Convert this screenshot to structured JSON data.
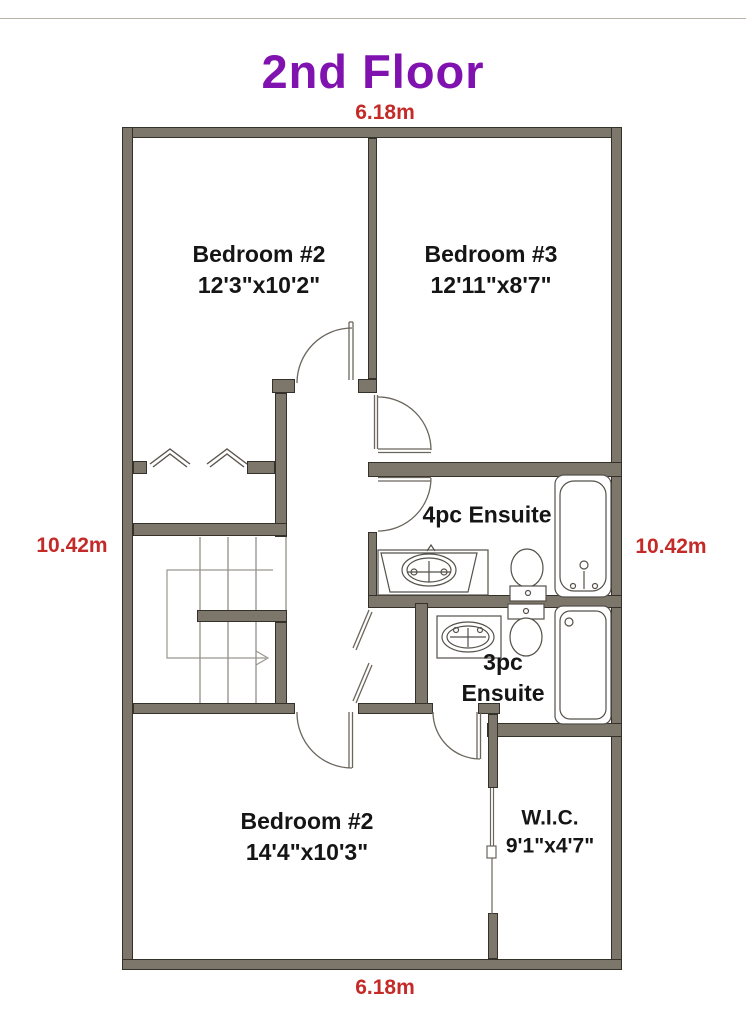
{
  "title": "2nd Floor",
  "dimensions": {
    "top": "6.18m",
    "bottom": "6.18m",
    "left": "10.42m",
    "right": "10.42m"
  },
  "rooms": {
    "bedroom2_top": {
      "name": "Bedroom #2",
      "size": "12'3\"x10'2\""
    },
    "bedroom3": {
      "name": "Bedroom #3",
      "size": "12'11\"x8'7\""
    },
    "ensuite_4pc": {
      "name": "4pc Ensuite"
    },
    "ensuite_3pc": {
      "line1": "3pc",
      "line2": "Ensuite"
    },
    "bedroom2_bottom": {
      "name": "Bedroom #2",
      "size": "14'4\"x10'3\""
    },
    "wic": {
      "name": "W.I.C.",
      "size": "9'1\"x4'7\""
    }
  },
  "colors": {
    "title": "#8012b0",
    "dimension": "#c42a27",
    "wall": "#7d776b"
  }
}
